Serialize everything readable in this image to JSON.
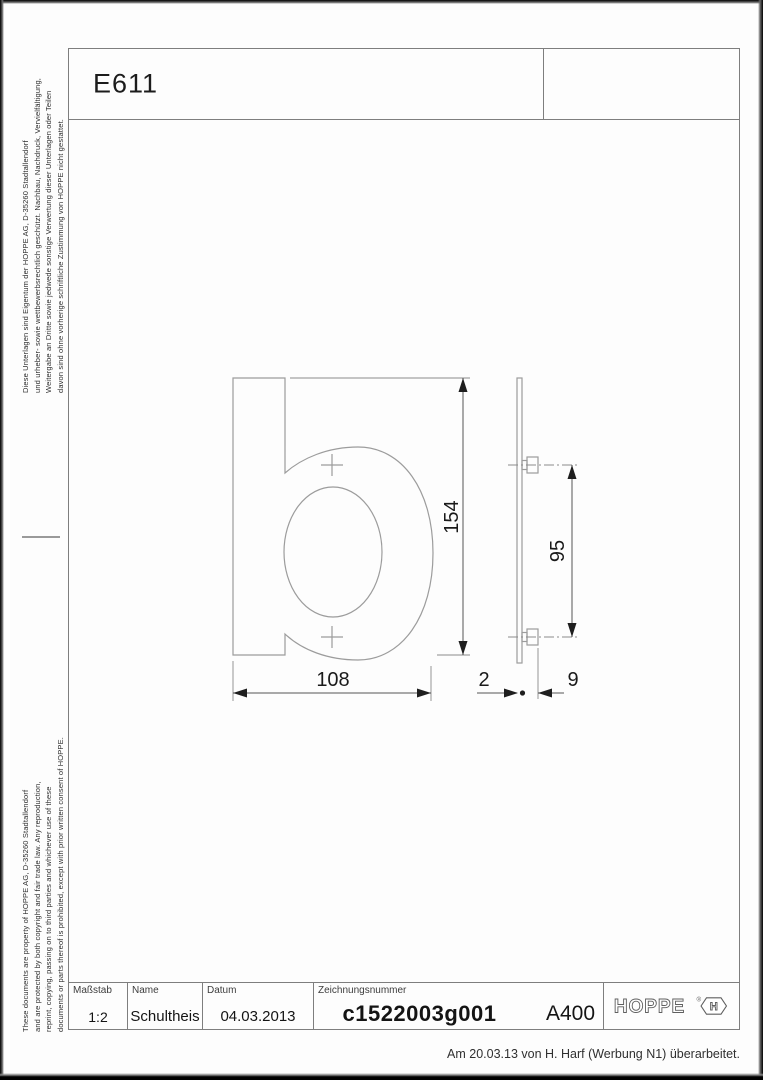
{
  "header": {
    "product_code": "E611"
  },
  "legal_notes": {
    "german_lines": [
      "Diese Unterlagen sind Eigentum der HOPPE AG, D-35260 Stadtallendorf",
      "und urheber- sowie wettbewerbsrechtlich geschützt. Nachbau, Nachdruck, Vervielfältigung,",
      "Weitergabe an Dritte sowie jedwede sonstige Verwertung dieser Unterlagen oder Teilen",
      "davon sind ohne vorherige schriftliche Zustimmung von HOPPE nicht gestattet."
    ],
    "english_lines": [
      "These documents are property of HOPPE AG, D-35260 Stadtallendorf",
      "and are protected by both copyright and fair trade law. Any reproduction,",
      "reprint, copying, passing on to third parties and whichever use of these",
      "documents or parts thereof is prohibited, except with prior written consent of HOPPE."
    ]
  },
  "drawing": {
    "glyph": "b",
    "dimensions": {
      "height": "154",
      "width": "108",
      "pin_spacing": "95",
      "plate_thickness": "2",
      "pin_length": "9"
    },
    "colors": {
      "part_line": "#9c9c9c",
      "dimension_line": "#555555",
      "dimension_text": "#1a1a1a"
    }
  },
  "title_block": {
    "scale_label": "Maßstab",
    "scale_value": "1:2",
    "name_label": "Name",
    "name_value": "Schultheis",
    "date_label": "Datum",
    "date_value": "04.03.2013",
    "drawing_number_label": "Zeichnungsnummer",
    "drawing_number_value": "c1522003g001",
    "revision_code": "A400",
    "brand": "HOPPE",
    "brand_registered": "®",
    "brand_mark_letter": "H"
  },
  "footer": {
    "revision_note": "Am 20.03.13 von H. Harf (Werbung N1) überarbeitet."
  }
}
